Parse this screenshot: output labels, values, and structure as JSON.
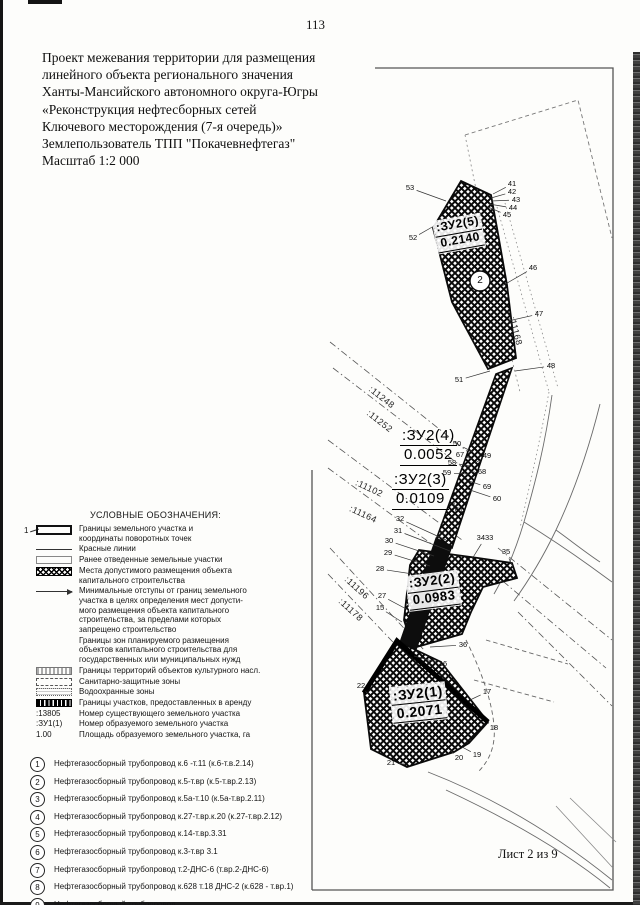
{
  "page": {
    "number": "113",
    "sheet_label": "Лист 2 из 9"
  },
  "title": {
    "text": "Проект межевания территории для размещения\nлинейного объекта регионального значения\nХанты-Мансийского автономного округа-Югры\n«Реконструкция нефтесборных сетей\nКлючевого месторождения (7-я очередь)»\nЗемлепользователь ТПП \"Покачевнефтегаз\"\nМасштаб 1:2 000"
  },
  "legend": {
    "title": "УСЛОВНЫЕ ОБОЗНАЧЕНИЯ:",
    "items": [
      {
        "symbol": "boundary",
        "marker": "1",
        "text": "Границы земельного участка и\nкоординаты поворотных точек"
      },
      {
        "symbol": "redline",
        "text": "Красные линии"
      },
      {
        "symbol": "prev",
        "text": "Ранее отведенные земельные участки"
      },
      {
        "symbol": "hatch",
        "text": "Места допустимого размещения объекта\nкапитального строительства"
      },
      {
        "symbol": "arrow",
        "text": "Минимальные отступы от границ земельного\nучастка в целях определения мест допусти-\nмого размещения объекта капитального\nстроительства, за пределами которых\nзапрещено строительство"
      },
      {
        "symbol": "none",
        "text": "Границы зон планируемого размещения\nобъектов капитального строительства для\nгосударственных или муниципальных нужд"
      },
      {
        "symbol": "culture",
        "text": "Границы территорий объектов культурного насл."
      },
      {
        "symbol": "sanitary",
        "text": "Санитарно-защитные зоны"
      },
      {
        "symbol": "water",
        "text": "Водоохранные зоны"
      },
      {
        "symbol": "lease",
        "text": "Границы участков, предоставленных в аренду"
      },
      {
        "symbol": "text",
        "symbol_text": ":13805",
        "text": "Номер существующего земельного участка"
      },
      {
        "symbol": "text",
        "symbol_text": ":ЗУ1(1)",
        "text": "Номер образуемого земельного участка"
      },
      {
        "symbol": "text",
        "symbol_text": "1.00",
        "text": "Площадь образуемого земельного участка, га"
      }
    ]
  },
  "pipelines": {
    "items": [
      {
        "num": "1",
        "text": "Нефтегазосборный трубопровод к.6 -т.11 (к.6-т.в.2.14)"
      },
      {
        "num": "2",
        "text": "Нефтегазосборный трубопровод к.5-т.вр (к.5-т.вр.2.13)"
      },
      {
        "num": "3",
        "text": "Нефтегазосборный трубопровод к.5а-т.10 (к.5а-т.вр.2.11)"
      },
      {
        "num": "4",
        "text": "Нефтегазосборный трубопровод к.27-т.вр.к.20 (к.27-т.вр.2.12)"
      },
      {
        "num": "5",
        "text": "Нефтегазосборный трубопровод к.14-т.вр.3.31"
      },
      {
        "num": "6",
        "text": "Нефтегазосборный трубопровод к.3-т.вр 3.1"
      },
      {
        "num": "7",
        "text": "Нефтегазосборный трубопровод т.2-ДНС-6 (т.вр.2-ДНС-6)"
      },
      {
        "num": "8",
        "text": "Нефтегазосборный трубопровод к.628 т.18 ДНС-2 (к.628 - т.вр.1)"
      },
      {
        "num": "9",
        "text": "Нефтегазосборный трубопровод\nк.636 (т.8 т.6) к.637 т.7 к.648 (т.5 т.8) (к.636 - т.вр.6)"
      }
    ]
  },
  "map": {
    "circled_point": {
      "label": "2",
      "x": 480,
      "y": 281
    },
    "zu_labels": [
      {
        "name": ":ЗУ2(5)",
        "area": "0.2140",
        "x": 433,
        "y": 222,
        "rot": -10,
        "boxed": true,
        "size": 12
      },
      {
        "name": ":ЗУ2(4)",
        "area": "0.0052",
        "x": 400,
        "y": 427,
        "rot": 0,
        "boxed": false,
        "size": 15
      },
      {
        "name": ":ЗУ2(3)",
        "area": "0.0109",
        "x": 392,
        "y": 471,
        "rot": 0,
        "boxed": false,
        "size": 15
      },
      {
        "name": ":ЗУ2(2)",
        "area": "0.0983",
        "x": 406,
        "y": 577,
        "rot": -7,
        "boxed": true,
        "size": 13
      },
      {
        "name": ":ЗУ2(1)",
        "area": "0.2071",
        "x": 390,
        "y": 688,
        "rot": -6,
        "boxed": true,
        "size": 14
      }
    ],
    "cadastral_labels": [
      {
        "text": ":11248",
        "x": 370,
        "y": 383,
        "rot": 38
      },
      {
        "text": ":11252",
        "x": 368,
        "y": 407,
        "rot": 38
      },
      {
        "text": ":11102",
        "x": 356,
        "y": 477,
        "rot": 25
      },
      {
        "text": ":11164",
        "x": 350,
        "y": 503,
        "rot": 25
      },
      {
        "text": ":11196",
        "x": 346,
        "y": 573,
        "rot": 42
      },
      {
        "text": ":11178",
        "x": 340,
        "y": 595,
        "rot": 42
      },
      {
        "text": ":11168",
        "x": 512,
        "y": 312,
        "rot": 75
      }
    ],
    "points": [
      {
        "t": "53",
        "lx": 410,
        "ly": 188,
        "tx": 446,
        "ty": 201
      },
      {
        "t": "52",
        "lx": 413,
        "ly": 238,
        "tx": 434,
        "ty": 226
      },
      {
        "t": "41",
        "lx": 512,
        "ly": 184,
        "tx": 493,
        "ty": 194
      },
      {
        "t": "42",
        "lx": 512,
        "ly": 192,
        "tx": 491,
        "ty": 198
      },
      {
        "t": "43",
        "lx": 516,
        "ly": 200,
        "tx": 491,
        "ty": 201
      },
      {
        "t": "44",
        "lx": 513,
        "ly": 208,
        "tx": 489,
        "ty": 204
      },
      {
        "t": "45",
        "lx": 507,
        "ly": 215,
        "tx": 488,
        "ty": 207
      },
      {
        "t": "46",
        "lx": 533,
        "ly": 268,
        "tx": 502,
        "ty": 286
      },
      {
        "t": "47",
        "lx": 539,
        "ly": 314,
        "tx": 508,
        "ty": 321
      },
      {
        "t": "48",
        "lx": 551,
        "ly": 366,
        "tx": 515,
        "ty": 371
      },
      {
        "t": "51",
        "lx": 459,
        "ly": 380,
        "tx": 490,
        "ty": 371
      },
      {
        "t": "50",
        "lx": 457,
        "ly": 444,
        "tx": 473,
        "ty": 452
      },
      {
        "t": "67",
        "lx": 460,
        "ly": 455,
        "tx": 472,
        "ty": 459
      },
      {
        "t": "58",
        "lx": 452,
        "ly": 463,
        "tx": 470,
        "ty": 466
      },
      {
        "t": "59",
        "lx": 447,
        "ly": 473,
        "tx": 468,
        "ty": 474
      },
      {
        "t": "49",
        "lx": 487,
        "ly": 456,
        "tx": 475,
        "ty": 463
      },
      {
        "t": "68",
        "lx": 482,
        "ly": 472,
        "tx": 471,
        "ty": 472
      },
      {
        "t": "69",
        "lx": 487,
        "ly": 487,
        "tx": 469,
        "ty": 481
      },
      {
        "t": "60",
        "lx": 497,
        "ly": 499,
        "tx": 467,
        "ty": 489
      },
      {
        "t": "61",
        "lx": 459,
        "ly": 510,
        "tx": 453,
        "ty": 502
      },
      {
        "t": "32",
        "lx": 400,
        "ly": 519,
        "tx": 446,
        "ty": 540
      },
      {
        "t": "31",
        "lx": 398,
        "ly": 531,
        "tx": 450,
        "ty": 551
      },
      {
        "t": "30",
        "lx": 389,
        "ly": 541,
        "tx": 434,
        "ty": 556
      },
      {
        "t": "29",
        "lx": 388,
        "ly": 553,
        "tx": 430,
        "ty": 566
      },
      {
        "t": "28",
        "lx": 380,
        "ly": 569,
        "tx": 426,
        "ty": 576
      },
      {
        "t": "27",
        "lx": 382,
        "ly": 596,
        "tx": 410,
        "ty": 611
      },
      {
        "t": "15",
        "lx": 380,
        "ly": 608,
        "tx": 402,
        "ty": 622
      },
      {
        "t": "3433",
        "lx": 485,
        "ly": 538,
        "tx": 472,
        "ty": 559
      },
      {
        "t": "35",
        "lx": 506,
        "ly": 552,
        "tx": 513,
        "ty": 567
      },
      {
        "t": "36",
        "lx": 463,
        "ly": 645,
        "tx": 430,
        "ty": 647
      },
      {
        "t": "16",
        "lx": 443,
        "ly": 664,
        "tx": 414,
        "ty": 656
      },
      {
        "t": "22",
        "lx": 361,
        "ly": 686,
        "tx": 367,
        "ty": 693
      },
      {
        "t": "17",
        "lx": 487,
        "ly": 692,
        "tx": 470,
        "ty": 700
      },
      {
        "t": "18",
        "lx": 494,
        "ly": 728,
        "tx": 488,
        "ty": 723
      },
      {
        "t": "19",
        "lx": 477,
        "ly": 755,
        "tx": 462,
        "ty": 747
      },
      {
        "t": "20",
        "lx": 459,
        "ly": 758,
        "tx": 450,
        "ty": 750
      },
      {
        "t": "21",
        "lx": 391,
        "ly": 763,
        "tx": 404,
        "ty": 764
      }
    ]
  }
}
